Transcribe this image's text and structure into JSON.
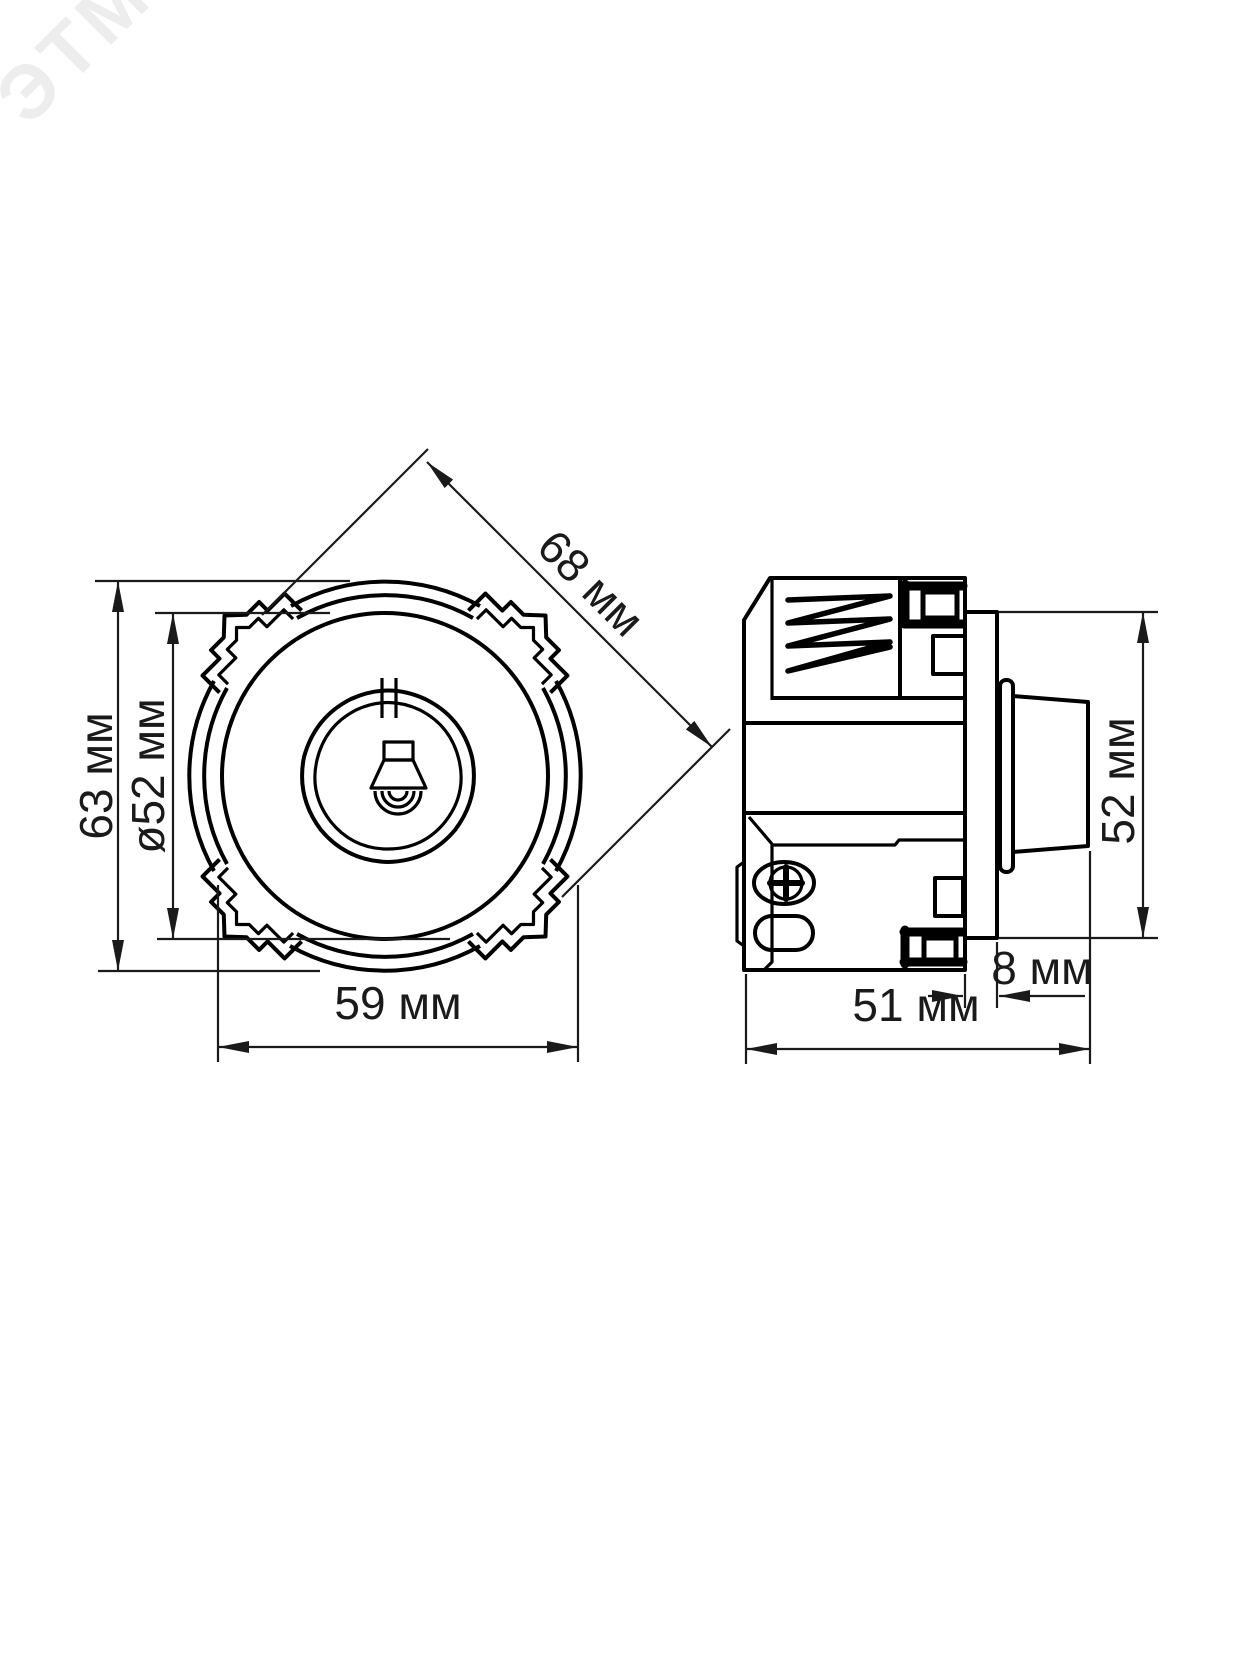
{
  "watermark": {
    "text": "ЭТМ",
    "color": "#ededed"
  },
  "views": {
    "front": {
      "label": "front-view",
      "dims": {
        "diagonal": "68 мм",
        "height": "63 мм",
        "knob_diameter": "ø52 мм",
        "width": "59 мм"
      }
    },
    "side": {
      "label": "side-view",
      "dims": {
        "height": "52 мм",
        "plate_offset": "8 мм",
        "depth": "51 мм"
      }
    }
  },
  "icons": [
    "lamp-icon",
    "knob-indicator-notch",
    "screw-phillips-icon"
  ],
  "colors": {
    "line": "#000000",
    "dimension": "#1a1a1a",
    "background": "#ffffff"
  }
}
